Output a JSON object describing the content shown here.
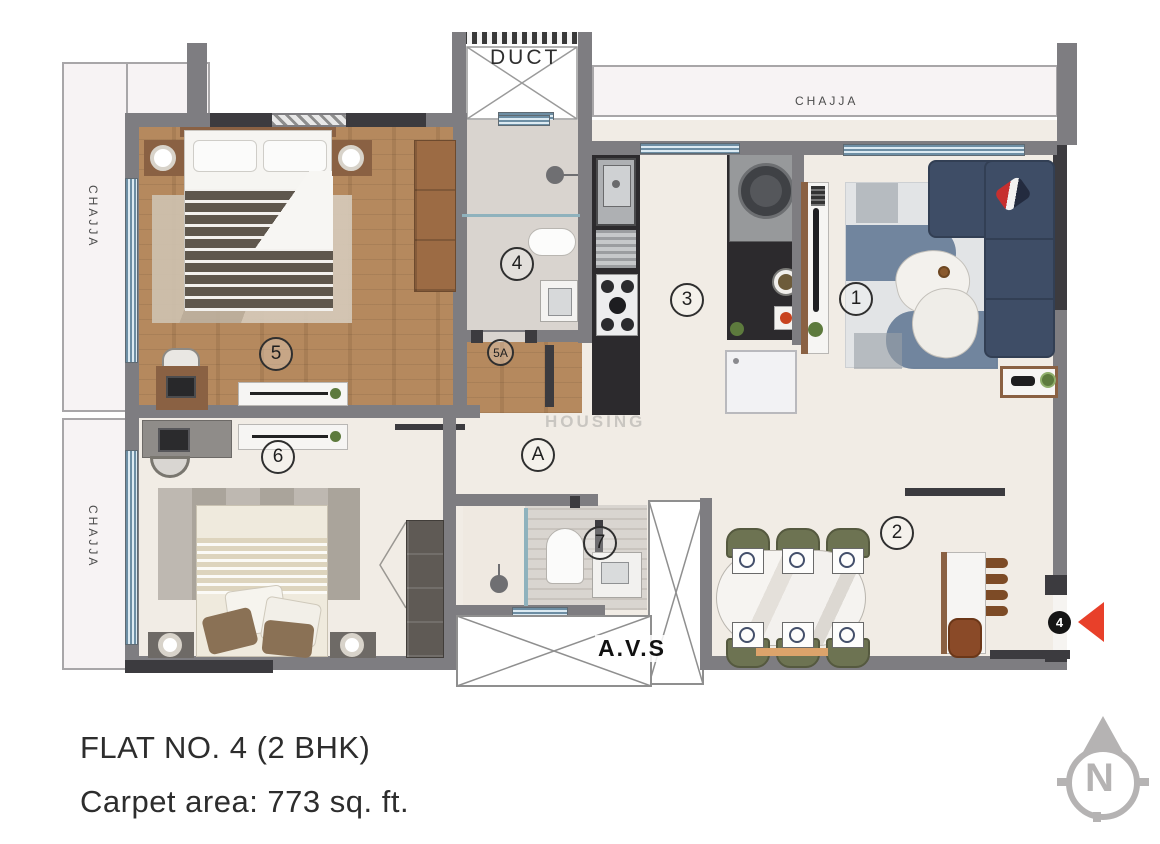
{
  "plan": {
    "duct_label": "DUCT",
    "chajja_label": "CHAJJA",
    "avs_label": "A.V.S",
    "watermark": "HOUSING"
  },
  "markers": {
    "living": "1",
    "dining": "2",
    "kitchen": "3",
    "bath1": "4",
    "bedroom1": "5",
    "passage": "5A",
    "bedroom2": "6",
    "bath2": "7",
    "corridor": "A"
  },
  "entry": {
    "flat_number": "4"
  },
  "compass": {
    "north_label": "N"
  },
  "title_block": {
    "line1": "FLAT NO. 4 (2 BHK)",
    "line2": "Carpet area: 773 sq. ft."
  },
  "colors": {
    "wall": "#7e7d81",
    "wall_dark": "#3c3b3f",
    "window_blue": "#dceaf2",
    "window_stripe": "#6d8ea4",
    "wood_floor": "#b5895e",
    "marble_floor": "#f1ece5",
    "tile_floor": "#d9d4cf",
    "counter_dark": "#2c2a2d",
    "sofa_navy": "#3e4d66",
    "dining_chair_olive": "#6d7352",
    "entry_arrow_red": "#e8402a",
    "compass_gray": "#b5b3b3"
  }
}
